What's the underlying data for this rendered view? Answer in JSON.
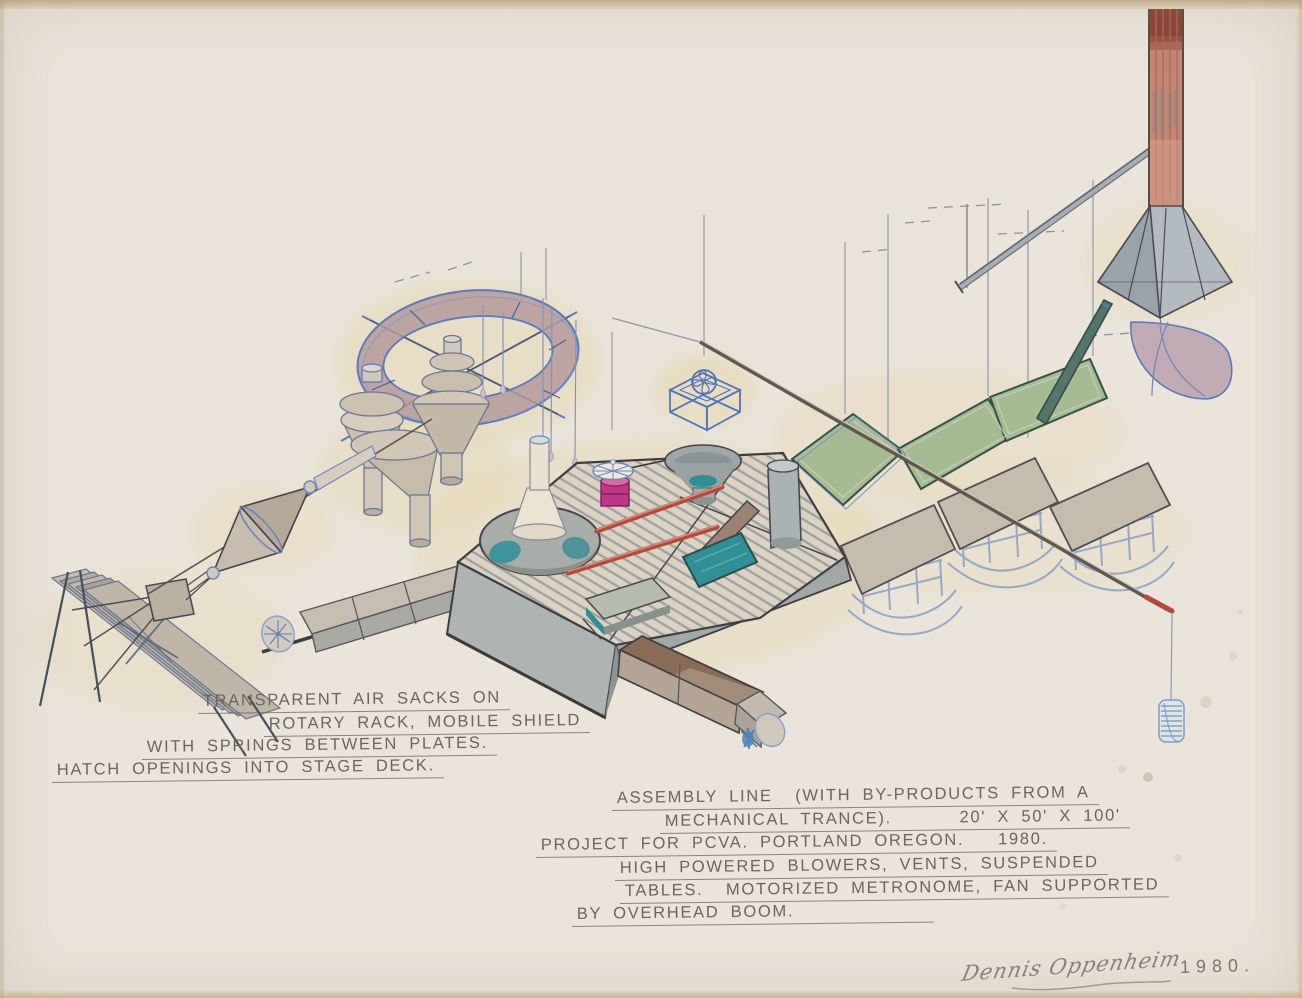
{
  "artwork": {
    "kind": "hand-drawn project study with watercolor and ink on cream paper",
    "annotations": {
      "left_note": {
        "lines": [
          "TRANSPARENT AIR SACKS ON",
          "ROTARY RACK, MOBILE SHIELD",
          "WITH SPRINGS BETWEEN PLATES.",
          "HATCH OPENINGS INTO STAGE DECK."
        ]
      },
      "right_note": {
        "lines": [
          "ASSEMBLY LINE  (WITH BY-PRODUCTS FROM A",
          "MECHANICAL TRANCE).      20' X 50' X 100'",
          "PROJECT FOR PCVA. PORTLAND OREGON.   1980.",
          "HIGH POWERED BLOWERS, VENTS, SUSPENDED",
          "TABLES.  MOTORIZED METRONOME, FAN SUPPORTED",
          "BY OVERHEAD BOOM."
        ]
      },
      "signature": "Dennis Oppenheim",
      "year": "1980."
    },
    "depicted_elements": [
      "rotary rack ring with hanging air sacks",
      "funnel vessels under ring",
      "mobile shield plates on A-frame",
      "spring bicone link",
      "striped stage deck with hatch plates",
      "plunger column in basin",
      "motorized metronome spool",
      "vent funnel",
      "blower cube",
      "folded green suspended panels",
      "three suspended tables on rockers",
      "overhead boom rod with red tip and hanging spool",
      "chimney stack with faceted hood and fan blade"
    ],
    "colors": {
      "paper": "#eae4da",
      "ring_mauve": "#b59a9c",
      "ink_blue": "#5b79bd",
      "pencil": "#6b655d",
      "panel_green": "#a6bb92",
      "teal": "#2f8f96",
      "magenta": "#c0368a",
      "red_rod": "#b34a3c",
      "chimney_salmon": "#c28874",
      "chimney_dark": "#8c4437",
      "deck_plank": "#dcd2bf",
      "table_taupe": "#c6bcae",
      "fan_mauve": "#c3abb6"
    }
  }
}
